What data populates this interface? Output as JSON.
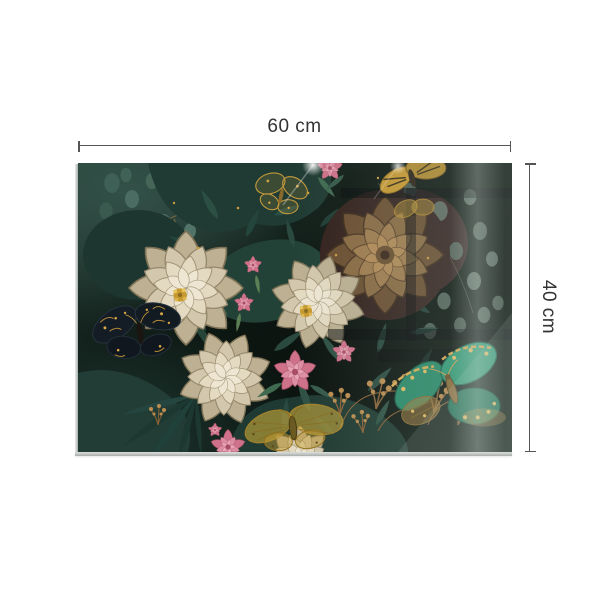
{
  "dimensions": {
    "width": {
      "label": "60 cm"
    },
    "height": {
      "label": "40 cm"
    }
  },
  "annotation": {
    "line_color": "#555555",
    "text_color": "#333333"
  },
  "artwork": {
    "palette": {
      "background_dark": "#0d1713",
      "foliage_teal": "#2e4f45",
      "foliage_faded": "#5a6e64",
      "flower_cream": "#e6dcc6",
      "flower_bronze": "#9a7a50",
      "flower_pink": "#d4768f",
      "gold": "#c9982e",
      "butterfly_teal": "#2e8f72"
    }
  }
}
